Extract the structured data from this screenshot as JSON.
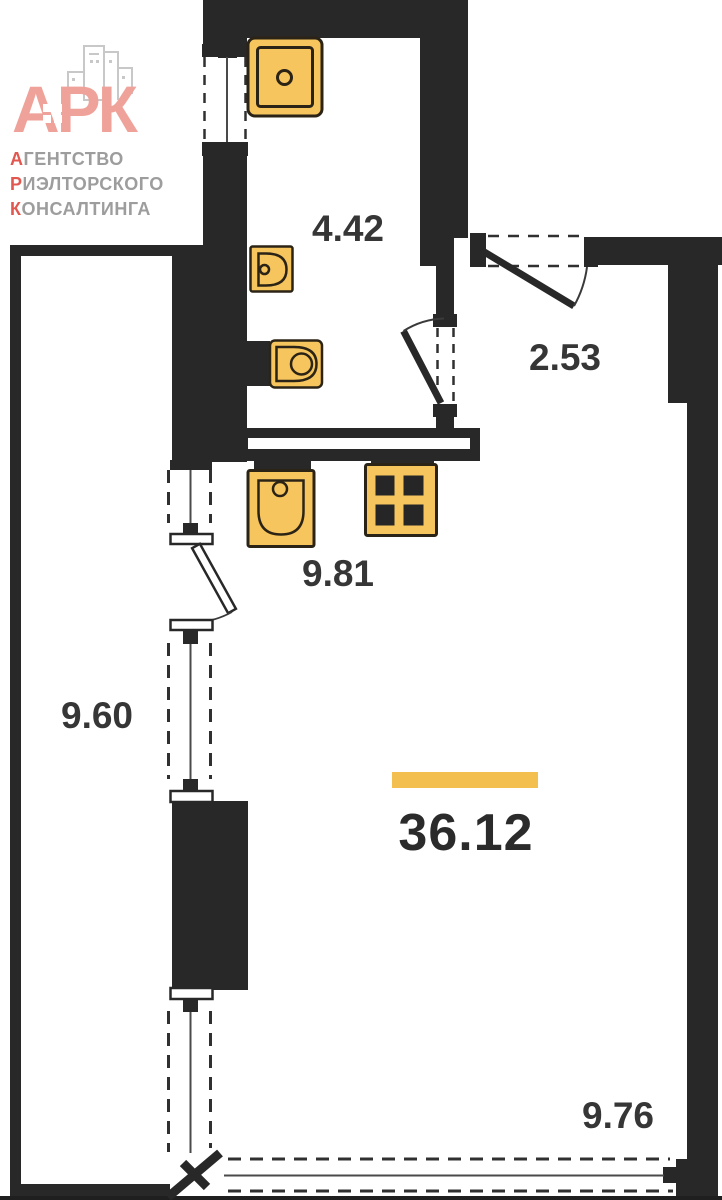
{
  "logo": {
    "letters": "АРК",
    "lines": [
      {
        "first": "А",
        "rest": "ГЕНТСТВО"
      },
      {
        "first": "Р",
        "rest": "ИЭЛТОРСКОГО"
      },
      {
        "first": "К",
        "rest": "ОНСАЛТИНГА"
      }
    ],
    "letters_color": "#efa29a",
    "accent_color": "#e2574f",
    "text_color": "#9d9d9d"
  },
  "rooms": {
    "shower_room": {
      "area": "4.42"
    },
    "hall": {
      "area": "2.53"
    },
    "kitchen": {
      "area": "9.81"
    },
    "balcony": {
      "area": "9.60"
    },
    "living": {
      "area": "36.12"
    },
    "terrace": {
      "area": "9.76"
    }
  },
  "colors": {
    "wall": "#282828",
    "fixture_fill": "#f7c55d",
    "fixture_stroke": "#2b2416",
    "accent_bar": "#f3c04f",
    "label": "#363636"
  },
  "icons": {
    "shower-tray-icon": "square tray with drain circle",
    "washbasin-icon": "wall basin with faucet dot",
    "toilet-icon": "toilet with cistern",
    "kitchen-sink-icon": "sink bowl with faucet dot",
    "stove-icon": "four-burner cooktop",
    "logo-buildings-icon": "city skyline outline"
  }
}
